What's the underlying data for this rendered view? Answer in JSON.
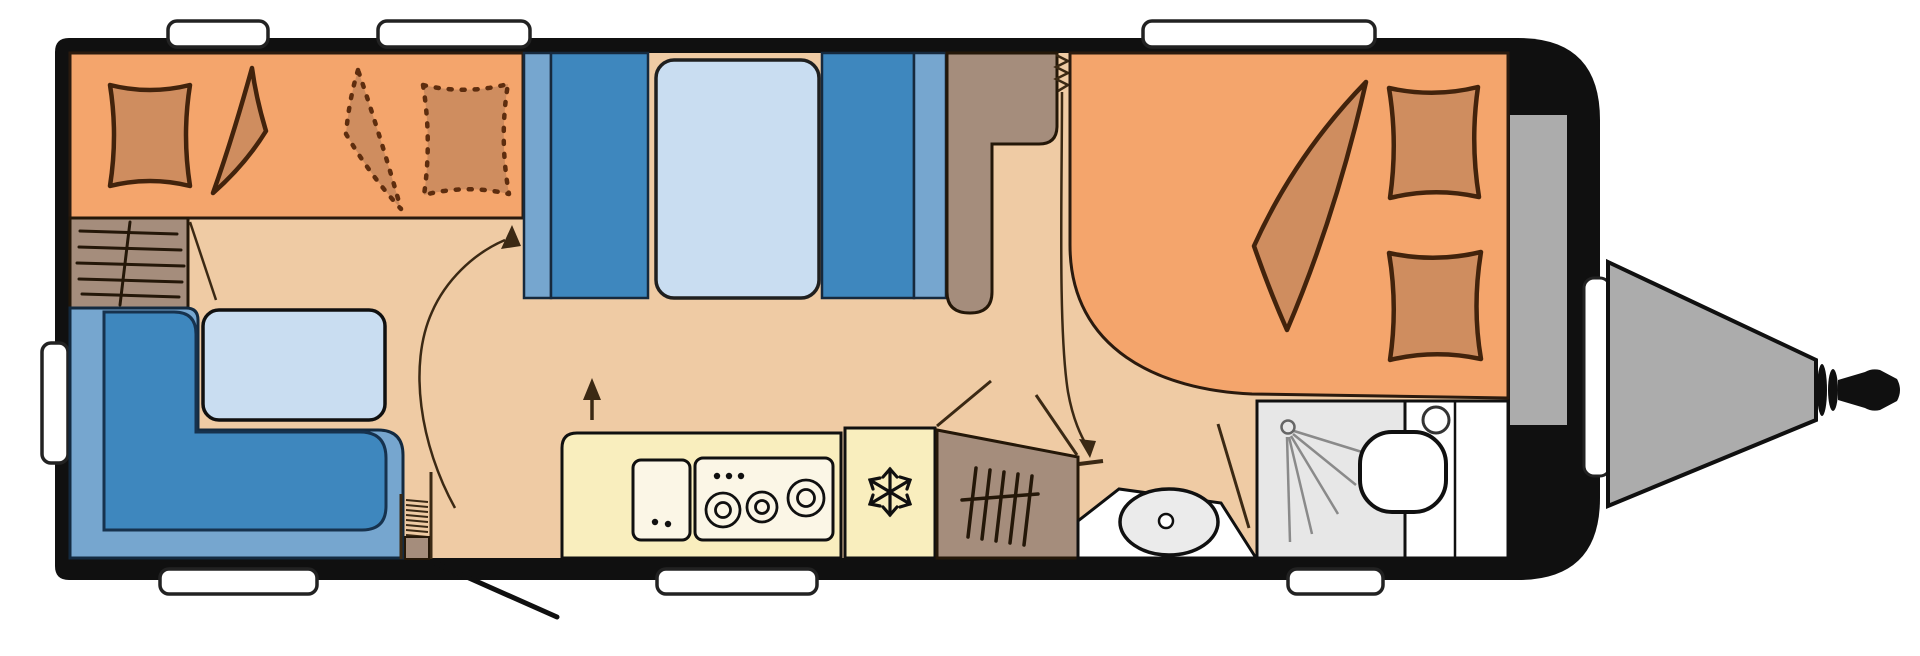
{
  "diagram": {
    "kind": "caravan-floor-plan",
    "orientation": "hitch-right",
    "visible_text": "",
    "background": "#FFFFFF"
  },
  "colors": {
    "ink": "#101010",
    "floor": "#EFCBA4",
    "bed": "#F4A56C",
    "bedding": "#CF8D5F",
    "bedding_outline": "#42230C",
    "bedding_dashed": "#5E2D0E",
    "annotation": "#3B2914",
    "seat_dark": "#3E87BE",
    "seat_light": "#76A6CF",
    "pale_blue": "#C9DDF1",
    "kitchen": "#F9EEBE",
    "appliance_panel": "#FBF6E6",
    "cabinet": "#A58D7C",
    "shower": "#E7E7E7",
    "fixture": "#EBEBEB",
    "white": "#FFFFFF",
    "chassis": "#ACACAC",
    "window_stroke": "#222222",
    "spray": "#8A8A8A"
  },
  "features": {
    "body": "caravan outer wall",
    "windows": "7 window tabs (3 top, 3 bottom, 1 left)",
    "left_bed": "transverse double bed with pillow, folded blanket and dashed fold-out bedding",
    "left_wardrobe": "wardrobe with clothes-rail icon and door swing",
    "dinette": "L-shaped seating group with table",
    "entry_door": "entry door with spring hinge and outward swing line",
    "bunks": "bunk bed section with pale mattress panel",
    "mid_cabinet": "L-shaped cabinet column",
    "curtain": "curtain coil with pull-down track arrow",
    "kitchen": "kitchen block with sink unit and 3-burner stove",
    "fridge": "refrigerator with snowflake icon",
    "rear_wardrobe": "angled wardrobe with clothes-rail icon and door swing lines",
    "washbasin": "washbasin oval in open alcove",
    "shower": "shower cabin with spray icon",
    "toilet": "toilet room with bowl and cistern circle",
    "right_bed": "french double bed with folded blanket and two pillows",
    "gas_locker": "front storage strip and lid tab",
    "drawbar": "A-frame drawbar with hitch coupling",
    "arrows": "walkway arrow annotations"
  }
}
